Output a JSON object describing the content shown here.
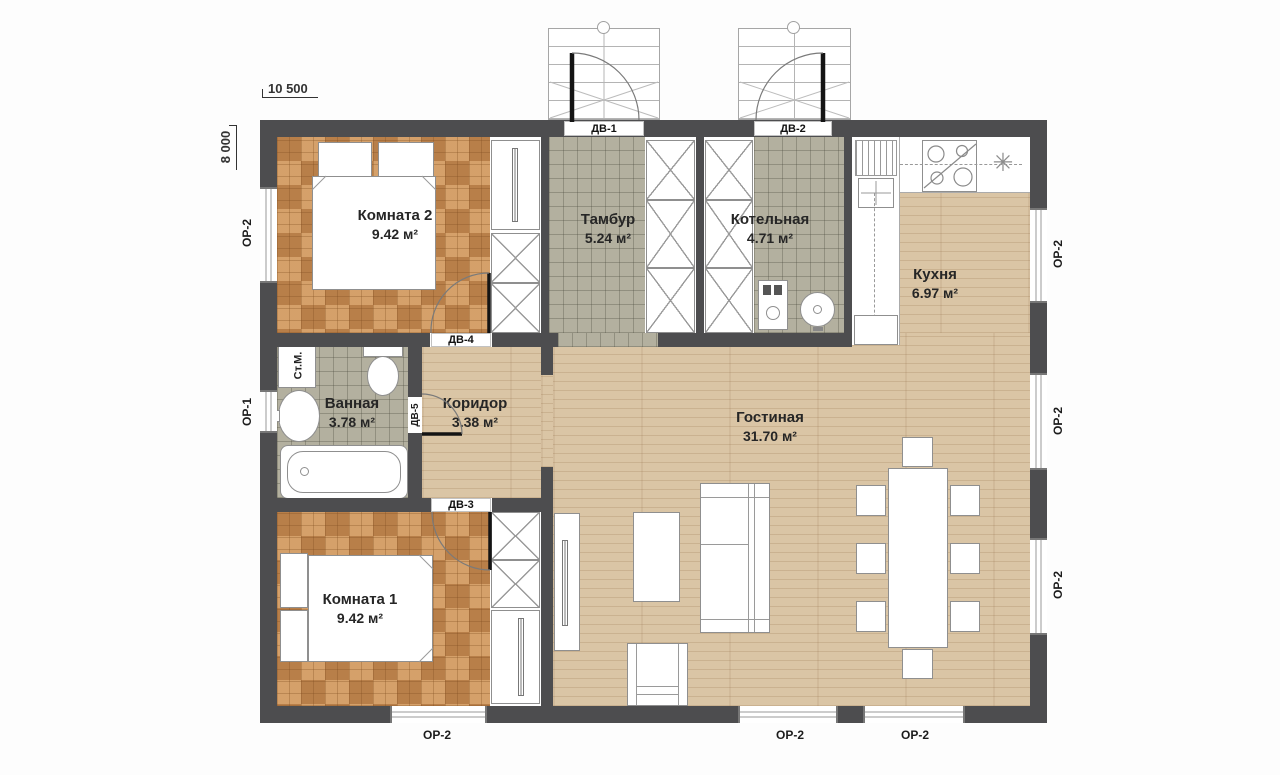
{
  "dimensions": {
    "width": "10 500",
    "height": "8 000"
  },
  "rooms": [
    {
      "name": "Комната 2",
      "area": "9.42 м²"
    },
    {
      "name": "Тамбур",
      "area": "5.24 м²"
    },
    {
      "name": "Котельная",
      "area": "4.71 м²"
    },
    {
      "name": "Кухня",
      "area": "6.97 м²"
    },
    {
      "name": "Ванная",
      "area": "3.78 м²"
    },
    {
      "name": "Коридор",
      "area": "3.38 м²"
    },
    {
      "name": "Гостиная",
      "area": "31.70 м²"
    },
    {
      "name": "Комната 1",
      "area": "9.42 м²"
    }
  ],
  "doors": {
    "dv1": "ДВ-1",
    "dv2": "ДВ-2",
    "dv3": "ДВ-3",
    "dv4": "ДВ-4",
    "dv5": "ДВ-5"
  },
  "windows": {
    "or1": "ОР-1",
    "or2": "ОР-2"
  },
  "labels": {
    "washing_machine": "Ст.М."
  },
  "icons": {
    "refrigerator": "✳"
  },
  "colors": {
    "wall": "#4d4d4f",
    "parquet": "#c98e55",
    "tile": "#b3b09f",
    "wood": "#dac5a5"
  }
}
